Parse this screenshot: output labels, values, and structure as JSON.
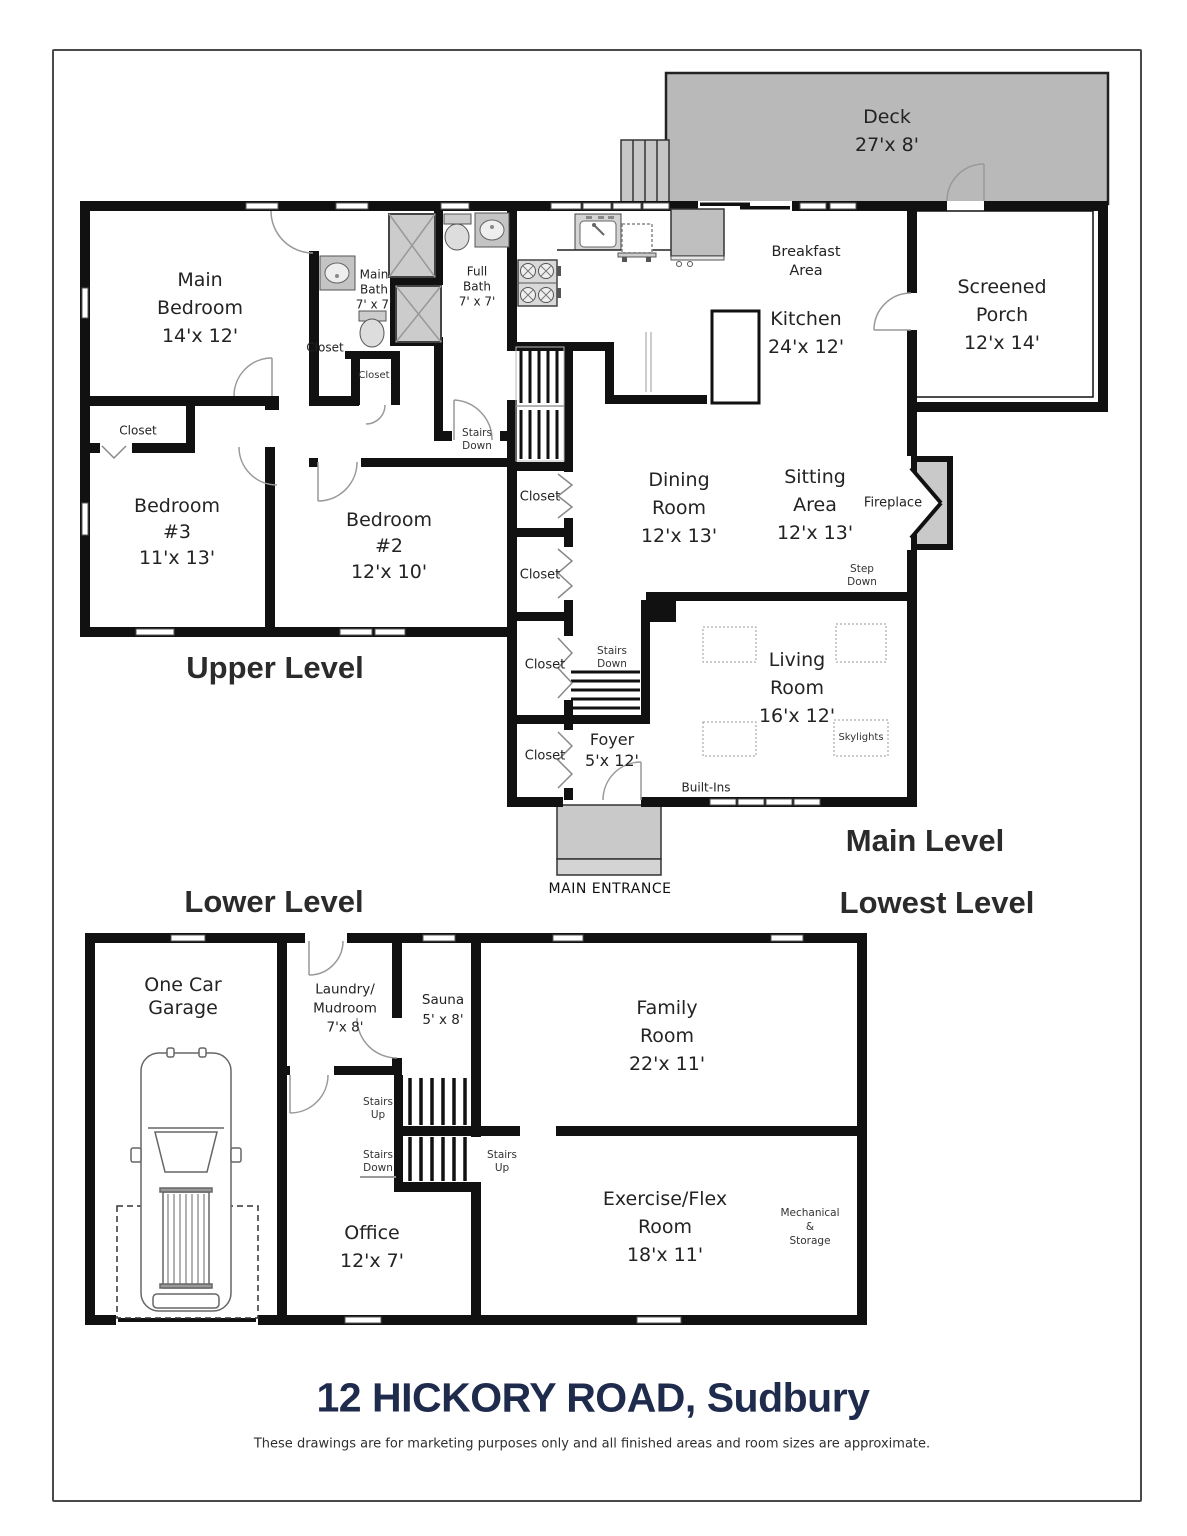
{
  "page": {
    "title": "12 HICKORY ROAD, Sudbury",
    "disclaimer": "These drawings are for marketing purposes only and all finished areas and room sizes are approximate.",
    "title_color": "#1f2b4d",
    "deck_fill": "#b9b9b9",
    "wall_color": "#111111"
  },
  "levels": {
    "upper": "Upper Level",
    "main": "Main Level",
    "lower": "Lower Level",
    "lowest": "Lowest Level"
  },
  "rooms": {
    "deck": {
      "lines": [
        "Deck",
        "27'x 8'"
      ]
    },
    "screened_porch": {
      "lines": [
        "Screened",
        "Porch",
        "12'x 14'"
      ]
    },
    "main_bedroom": {
      "lines": [
        "Main",
        "Bedroom",
        "14'x 12'"
      ]
    },
    "main_bath": {
      "lines": [
        "Main",
        "Bath",
        "7' x 7'"
      ]
    },
    "full_bath": {
      "lines": [
        "Full",
        "Bath",
        "7' x 7'"
      ]
    },
    "breakfast_area": {
      "lines": [
        "Breakfast",
        "Area"
      ]
    },
    "kitchen": {
      "lines": [
        "Kitchen",
        "24'x 12'"
      ]
    },
    "dining_room": {
      "lines": [
        "Dining",
        "Room",
        "12'x 13'"
      ]
    },
    "sitting_area": {
      "lines": [
        "Sitting",
        "Area",
        "12'x 13'"
      ]
    },
    "bedroom_3": {
      "lines": [
        "Bedroom",
        "#3",
        "11'x 13'"
      ]
    },
    "bedroom_2": {
      "lines": [
        "Bedroom",
        "#2",
        "12'x 10'"
      ]
    },
    "living_room": {
      "lines": [
        "Living",
        "Room",
        "16'x 12'"
      ]
    },
    "foyer": {
      "lines": [
        "Foyer",
        "5'x 12'"
      ]
    },
    "one_car_garage": {
      "lines": [
        "One Car",
        "Garage"
      ]
    },
    "laundry_mudroom": {
      "lines": [
        "Laundry/",
        "Mudroom",
        "7'x 8'"
      ]
    },
    "sauna": {
      "lines": [
        "Sauna",
        "5' x 8'"
      ]
    },
    "family_room": {
      "lines": [
        "Family",
        "Room",
        "22'x 11'"
      ]
    },
    "office": {
      "lines": [
        "Office",
        "12'x 7'"
      ]
    },
    "exercise_flex": {
      "lines": [
        "Exercise/Flex",
        "Room",
        "18'x 11'"
      ]
    },
    "mechanical_storage": {
      "lines": [
        "Mechanical",
        "&",
        "Storage"
      ]
    }
  },
  "labels": {
    "closet": "Closet",
    "stairs": "Stairs",
    "up": "Up",
    "down": "Down",
    "step": "Step",
    "fireplace": "Fireplace",
    "skylights": "Skylights",
    "built_ins": "Built-Ins",
    "main_entrance": "MAIN ENTRANCE"
  }
}
